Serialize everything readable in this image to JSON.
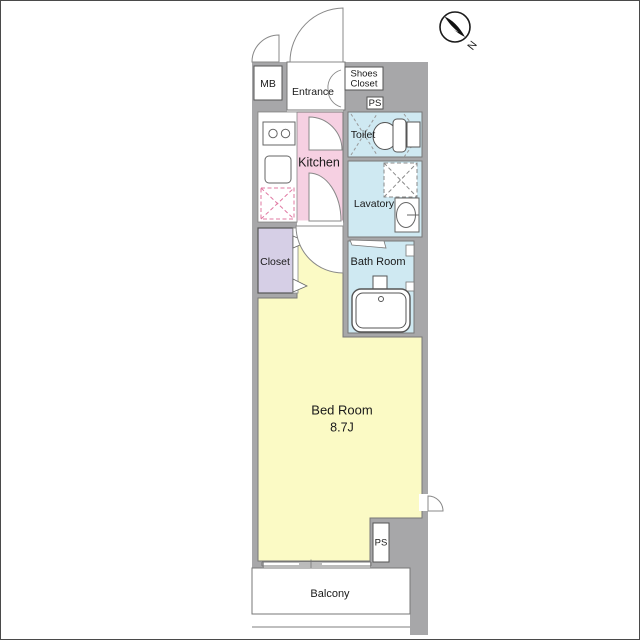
{
  "plan": {
    "labels": {
      "mb": "MB",
      "entrance": "Entrance",
      "shoes_closet_line1": "Shoes",
      "shoes_closet_line2": "Closet",
      "ps_top": "PS",
      "toilet": "Toilet",
      "kitchen": "Kitchen",
      "lavatory": "Lavatory",
      "closet": "Closet",
      "bath_room": "Bath Room",
      "bed_room": "Bed Room",
      "bed_room_size": "8.7J",
      "ps_bottom": "PS",
      "balcony": "Balcony",
      "compass_north": "N"
    },
    "colors": {
      "wall": "#a7a7a9",
      "outline": "#6e6e6e",
      "kitchen": "#f6d0e2",
      "wet": "#cfe9f2",
      "closet": "#d6cfe6",
      "bedroom": "#fbfac5",
      "fridge_dash": "#e078a2"
    }
  }
}
